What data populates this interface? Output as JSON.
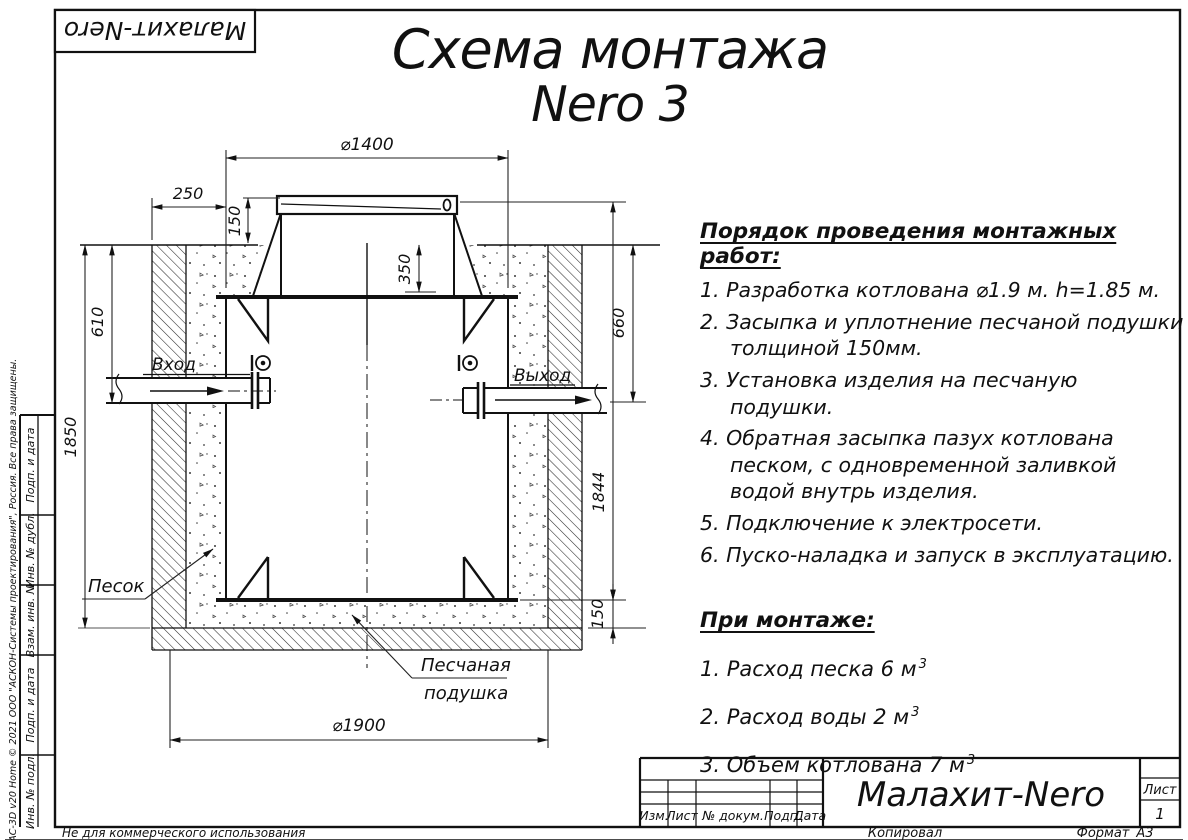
{
  "logo": {
    "text": "Малахит-Nero"
  },
  "title": {
    "line1": "Схема монтажа",
    "line2": "Nero 3"
  },
  "instructions": {
    "heading": "Порядок проведения монтажных работ:",
    "steps": [
      "1. Разработка котлована ⌀1.9 м. h=1.85 м.",
      "2. Засыпка и уплотнение песчаной подушки толщиной 150мм.",
      "3. Установка изделия на песчаную подушки.",
      "4. Обратная засыпка пазух котлована песком, с одновременной заливкой водой внутрь изделия.",
      "5. Подключение к электросети.",
      "6. Пуско-наладка и запуск в эксплуатацию."
    ]
  },
  "montage": {
    "heading": "При монтаже:",
    "items": [
      {
        "text": "1. Расход песка 6 м",
        "sup": "3"
      },
      {
        "text": "2. Расход воды 2 м",
        "sup": "3"
      },
      {
        "text": "3. Объем котлована 7 м",
        "sup": "3"
      }
    ]
  },
  "drawing": {
    "dims": {
      "d1400": "⌀1400",
      "d250": "250",
      "d150_top": "150",
      "d350": "350",
      "d610": "610",
      "d1850": "1850",
      "d660": "660",
      "d1844": "1844",
      "d150_bottom": "150",
      "d1900": "⌀1900"
    },
    "labels": {
      "inlet": "Вход",
      "outlet": "Выход",
      "sand": "Песок",
      "cushion1": "Песчаная",
      "cushion2": "подушка"
    }
  },
  "title_block": {
    "columns": [
      "Изм.",
      "Лист",
      "№ докум.",
      "Подп.",
      "Дата"
    ],
    "name": "Малахит-Nero",
    "sheet_label": "Лист",
    "sheet_number": "1",
    "copied_label": "Копировал",
    "format_label": "Формат",
    "format_value": "А3"
  },
  "margins": {
    "kompas": "КОМПАС-3D v20 Home © 2021 ООО \"АСКОН-Системы проектирования\", Россия. Все права защищены.",
    "not_commercial": "Не для коммерческого использования",
    "stamp_cells": [
      "Подп. и дата",
      "Инв. № дубл.",
      "Взам. инв. №",
      "Подп. и дата",
      "Инв. № подл."
    ]
  }
}
